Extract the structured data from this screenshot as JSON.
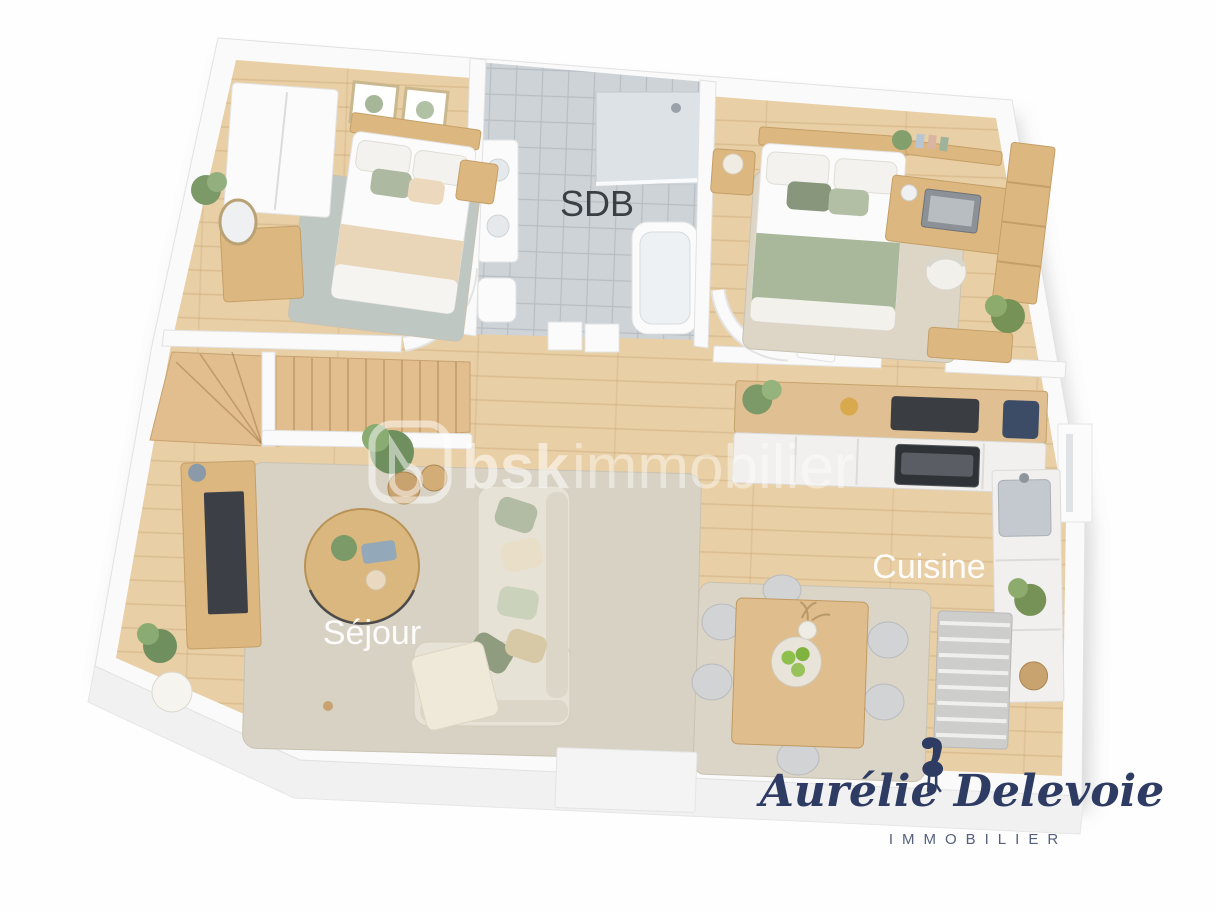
{
  "labels": {
    "bathroom": "SDB",
    "kitchen": "Cuisine",
    "living_room": "Séjour"
  },
  "watermark": {
    "bold": "bsk",
    "light": "immobilier",
    "logo_icon": "bsk-rounded-square-logo"
  },
  "branding": {
    "name": "Aurélie Delevoie",
    "subtitle": "IMMOBILIER",
    "icon": "flamingo-icon"
  },
  "palette": {
    "navy": "#2e3b63",
    "wood_floor": "#e9cfa5",
    "wood_furniture": "#dcb77f",
    "tile": "#ced3d7",
    "rug": "#d8d2c4",
    "bedroom1_rug": "#bfc7c3",
    "sage": "#a9b79a",
    "wall": "#fafafa"
  }
}
